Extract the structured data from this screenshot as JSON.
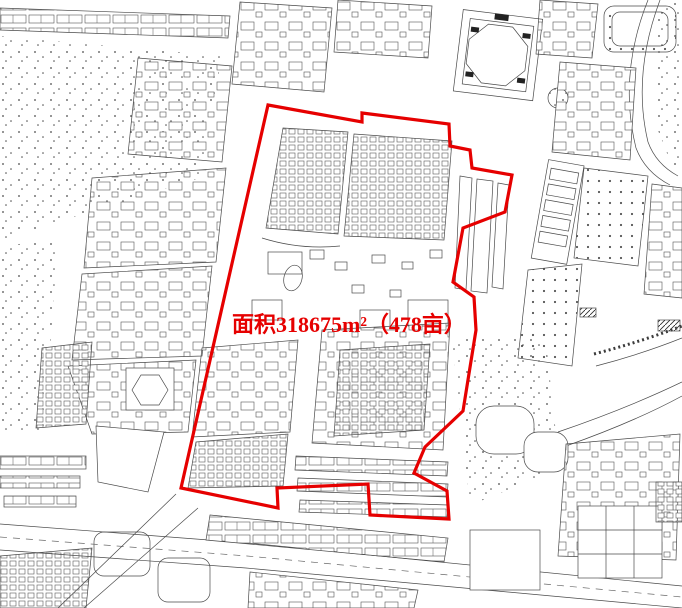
{
  "map": {
    "canvas": {
      "width": 682,
      "height": 608,
      "background": "#ffffff",
      "map_line_color": "#4a4a4a"
    },
    "area_label": {
      "text": "面积318675m²（478亩）",
      "color": "#e60000",
      "font_size_px": 22,
      "x": 232,
      "y": 332
    },
    "boundary": {
      "color": "#e60000",
      "stroke_width": 3.2,
      "points": [
        [
          268,
          105
        ],
        [
          362,
          122
        ],
        [
          362,
          113
        ],
        [
          449,
          124
        ],
        [
          450,
          146
        ],
        [
          470,
          150
        ],
        [
          472,
          168
        ],
        [
          512,
          175
        ],
        [
          505,
          212
        ],
        [
          463,
          228
        ],
        [
          453,
          282
        ],
        [
          474,
          297
        ],
        [
          476,
          330
        ],
        [
          463,
          411
        ],
        [
          425,
          447
        ],
        [
          414,
          473
        ],
        [
          447,
          491
        ],
        [
          449,
          519
        ],
        [
          370,
          515
        ],
        [
          368,
          484
        ],
        [
          277,
          488
        ],
        [
          278,
          508
        ],
        [
          181,
          488
        ]
      ]
    }
  }
}
